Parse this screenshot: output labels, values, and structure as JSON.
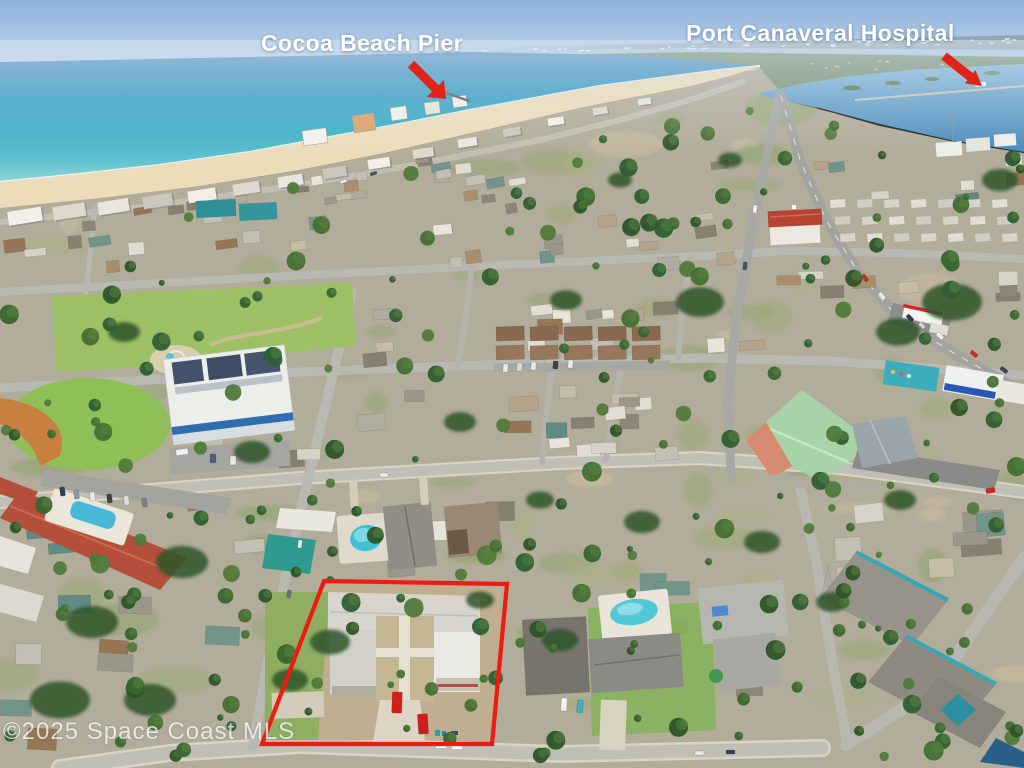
{
  "annotations": {
    "pier_label": "Cocoa Beach Pier",
    "hospital_label": "Port Canaveral Hospital",
    "watermark": "©2025 Space Coast MLS",
    "label_color": "#ffffff",
    "arrow_color": "#e42318",
    "outline_color": "#ee1b12"
  },
  "scene": {
    "type": "aerial-photo",
    "subject": "oceanfront neighborhood with outlined multi-family property",
    "palette": {
      "sky": "#8db2da",
      "ocean_far": "#5a8fc2",
      "ocean_near": "#64c4d0",
      "surf": "#ffffff",
      "sand": "#ecdcba",
      "lagoon": "#4687b8",
      "urban": "#b2ac9a",
      "park_lawn": "#9cc063",
      "ballfield_clay": "#c8803f",
      "tree": "#2e5429",
      "road": "#b7b6ae",
      "red_tile_roof": "#b34f3a",
      "plaza_roof": "#a8d3a9",
      "pool_water": "#49c0d4",
      "red_car": "#d41e18"
    }
  }
}
